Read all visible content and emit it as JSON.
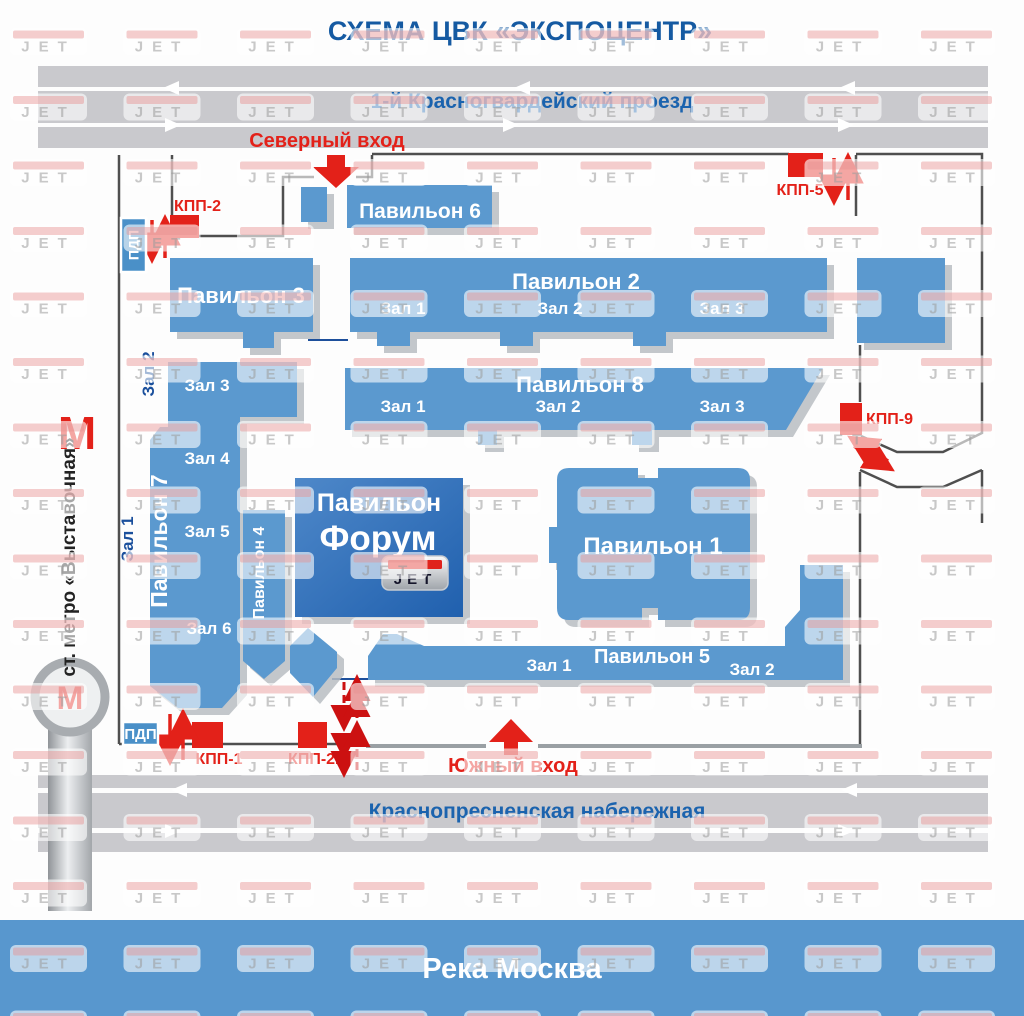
{
  "title": "СХЕМА ЦВК «ЭКСПОЦЕНТР»",
  "roads": {
    "north": "1-й Красногвардейский проезд",
    "south": "Краснопресненская набережная"
  },
  "river": {
    "label": "Река Москва"
  },
  "entrances": {
    "north": "Северный вход",
    "south": "Южный вход"
  },
  "checkpoints": {
    "kpp1": "КПП-1",
    "kpp2": "КПП-2",
    "kpp5": "КПП-5",
    "kpp9": "КПП-9",
    "kpp21": "КПП-21"
  },
  "pdp": {
    "north": "ПДП",
    "south": "ПДП"
  },
  "metro": {
    "symbol": "М",
    "station": "ст. метро «Выставочная»"
  },
  "pavilions": {
    "p6": {
      "name": "Павильон 6"
    },
    "p3": {
      "name": "Павильон 3"
    },
    "p2": {
      "name": "Павильон 2",
      "halls": [
        "Зал 1",
        "Зал 2",
        "Зал 3"
      ]
    },
    "p8": {
      "name": "Павильон 8",
      "halls": [
        "Зал 1",
        "Зал 2",
        "Зал 3"
      ]
    },
    "p7": {
      "name": "Павильон 7",
      "halls_inside": [
        "Зал 3",
        "Зал 4",
        "Зал 5",
        "Зал 6"
      ],
      "halls_west": [
        "Зал 1",
        "Зал 2"
      ]
    },
    "p4": {
      "name": "Павильон 4"
    },
    "forum": {
      "line1": "Павильон",
      "line2": "Форум",
      "logo": "JET"
    },
    "p1": {
      "name": "Павильон 1"
    },
    "p5": {
      "name": "Павильон 5",
      "halls": [
        "Зал 1",
        "Зал 2"
      ]
    }
  },
  "watermark": "JET",
  "colors": {
    "pavilion_blue": "#5b99cf",
    "forum_blue": "#2060ae",
    "accent_red": "#e32119",
    "road_gray": "#c9c9cd",
    "title_blue": "#155aa2",
    "road_text_blue": "#1b63ae",
    "river_blue": "#5897ce",
    "fence_dark": "#4f4f4f",
    "hall_label_blue": "#1a4f9c"
  }
}
